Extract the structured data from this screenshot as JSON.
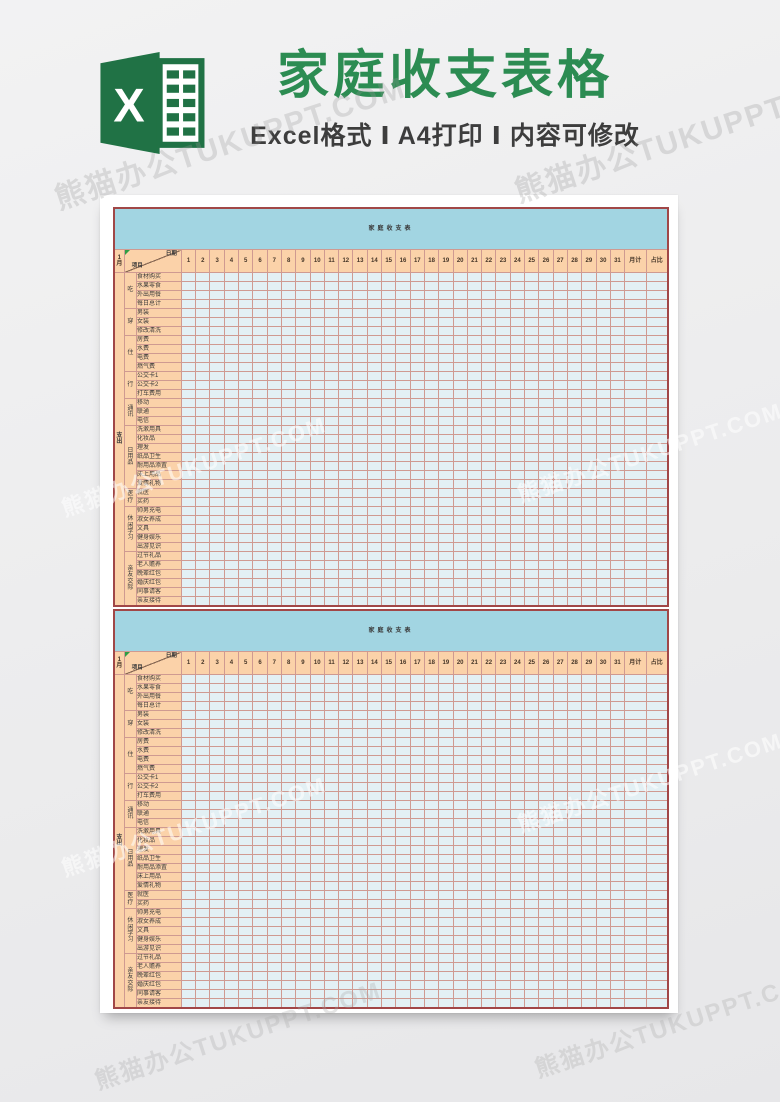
{
  "watermark": {
    "text": "熊猫办公TUKUPPT.COM"
  },
  "header": {
    "title": "家庭收支表格",
    "subtitle": "Excel格式 Ⅰ A4打印 Ⅰ 内容可修改",
    "icon_letter": "X",
    "title_color": "#2c8c52",
    "icon_green": "#207245"
  },
  "sheet": {
    "corner": {
      "month": "1月",
      "top_right": "日期",
      "bottom_left": "项目"
    },
    "axis_label": "支出",
    "days": [
      "1",
      "2",
      "3",
      "4",
      "5",
      "6",
      "7",
      "8",
      "9",
      "10",
      "11",
      "12",
      "13",
      "14",
      "15",
      "16",
      "17",
      "18",
      "19",
      "20",
      "21",
      "22",
      "23",
      "24",
      "25",
      "26",
      "27",
      "28",
      "29",
      "30",
      "31"
    ],
    "extra_columns": [
      "月计",
      "占比"
    ],
    "groups": [
      {
        "label": "吃",
        "items": [
          "食材购买",
          "水果零食",
          "外出用餐",
          "每日总计"
        ]
      },
      {
        "label": "穿",
        "items": [
          "男装",
          "女装",
          "修改清洗"
        ]
      },
      {
        "label": "住",
        "items": [
          "房费",
          "水费",
          "电费",
          "燃气费"
        ]
      },
      {
        "label": "行",
        "items": [
          "公交卡1",
          "公交卡2",
          "打车费用"
        ]
      },
      {
        "label": "通讯",
        "items": [
          "移动",
          "联通",
          "电信"
        ]
      },
      {
        "label": "日用品",
        "items": [
          "洗漱用具",
          "化妆品",
          "理发",
          "纸品卫生",
          "耐用品添置",
          "床上用品",
          "爱情礼物"
        ]
      },
      {
        "label": "医疗",
        "items": [
          "就医",
          "买药"
        ]
      },
      {
        "label": "休闲学习",
        "items": [
          "帅男充电",
          "淑女养成",
          "文具",
          "健身娱乐",
          "出游见识"
        ]
      },
      {
        "label": "亲友交际",
        "items": [
          "过节礼品",
          "老人赡养",
          "晚辈红包",
          "婚庆红包",
          "同事请客",
          "亲友接待"
        ]
      }
    ]
  },
  "tables": [
    {
      "title": "家庭收支表"
    },
    {
      "title": "家庭收支表"
    }
  ],
  "colors": {
    "sheet_title_band": "#a2d5e2",
    "header_peach": "#fbd2a9",
    "body_cell": "#e3f0f4",
    "outer_border": "#a14747",
    "grid_line": "#cf9a91"
  }
}
